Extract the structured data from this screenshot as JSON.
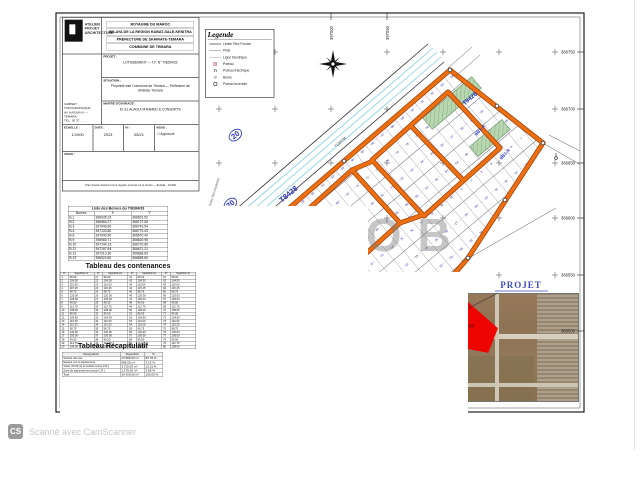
{
  "scanner": {
    "badge": "CS",
    "text": "Scanné avec CamScanner"
  },
  "title_block": {
    "firm_lines": [
      "ATELIER",
      "PROJET",
      "ARCHITECTURE"
    ],
    "org_lines": [
      "ROYAUME DU MAROC",
      "WILAYA DE LA REGION RABAT-SALE-KENITRA",
      "PREFECTURE DE SKHIRATE-TEMARA",
      "COMMUNE DE TEMARA"
    ],
    "cabinet_lines": [
      "CABINET TOPOGRAPHIQUE",
      "AV. HASSAN II — TEMARA",
      "TEL : 05 37 .. .. .."
    ],
    "projet_label": "PROJET :",
    "projet_text": "LOTISSEMENT — T.F. N° T/8264/33",
    "situation_label": "SITUATION :",
    "situation_text": "Propriété sise Commune de Témara — Préfecture de Skhirate-Témara",
    "moa_label": "MAITRE D'OUVRAGE :",
    "moa_text": "M. EL ALAOUI M'HAMED & CONSORTS",
    "echelle_label": "ECHELLE :",
    "echelle": "1/1000",
    "date_label": "DATE :",
    "date": "2021",
    "num_label": "N° :",
    "num": "05/21",
    "visas_label": "VISAS :",
    "visa_check": "☐ Approuvé",
    "footnote": "Plan dressé d'après le levé régulier exécuté sur le terrain — Echelle : 1/1000"
  },
  "legend": {
    "title": "Legende",
    "items": [
      {
        "sym": "solid",
        "label": "Limite Titre Foncier"
      },
      {
        "sym": "piste",
        "label": "Piste"
      },
      {
        "sym": "elec",
        "label": "Ligne Electrique"
      },
      {
        "sym": "poteau",
        "label": "Poteau"
      },
      {
        "sym": "pylone",
        "label": "Poteau Electrique"
      },
      {
        "sym": "borne",
        "label": "Borne"
      },
      {
        "sym": "incendie",
        "label": "Poteau Incendie"
      }
    ]
  },
  "bornes_table": {
    "title": "Liste des Bornes du T/8264/33",
    "headers": [
      "Bornes",
      "X",
      "Y"
    ],
    "rows": [
      [
        "B.1",
        "396935.24",
        "366691.52"
      ],
      [
        "B.2",
        "396984.27",
        "366727.05"
      ],
      [
        "B.3",
        "397040.60",
        "366743.54"
      ],
      [
        "B.4",
        "397133.80",
        "366770.43"
      ],
      [
        "B.8",
        "397040.90",
        "366670.40"
      ],
      [
        "B.9",
        "396983.71",
        "366620.95"
      ],
      [
        "B.10",
        "397144.12",
        "366720.85"
      ],
      [
        "B.11",
        "397197.84",
        "366671.21"
      ],
      [
        "B.12",
        "397213.30",
        "366688.85"
      ],
      [
        "B.13",
        "396924.50",
        "366655.60"
      ]
    ]
  },
  "contenances": {
    "title": "Tableau des contenances",
    "col_headers": [
      "N°",
      "Superficie m²"
    ],
    "groups": 4,
    "surfaces": [
      "96.00",
      "104.50",
      "110.00",
      "115.25",
      "98.75",
      "120.00",
      "105.00",
      "99.50",
      "112.75",
      "108.00",
      "96.00",
      "104.50",
      "110.00",
      "115.25",
      "98.75",
      "120.00",
      "105.00",
      "99.50",
      "112.75",
      "108.00",
      "96.00",
      "104.50",
      "110.00",
      "115.25",
      "98.75",
      "120.00",
      "105.00",
      "99.50",
      "112.75",
      "108.00",
      "96.00",
      "104.50",
      "110.00",
      "115.25",
      "98.75",
      "120.00",
      "105.00",
      "99.50",
      "112.75",
      "108.00",
      "96.00",
      "104.50",
      "110.00",
      "115.25",
      "98.75",
      "120.00",
      "105.00",
      "99.50",
      "112.75",
      "108.00",
      "96.00",
      "104.50",
      "110.00",
      "115.25",
      "98.75",
      "120.00",
      "105.00",
      "99.50",
      "112.75",
      "108.00",
      "96.00",
      "104.50",
      "110.00",
      "115.25",
      "98.75",
      "120.00",
      "105.00",
      "99.50",
      "112.75",
      "108.00",
      "96.00",
      "104.50",
      "110.00",
      "115.25",
      "98.75",
      "120.00",
      "105.00",
      "99.50",
      "112.75",
      "108.00"
    ]
  },
  "recap": {
    "title": "Tableau Récapitulatif",
    "headers": [
      "Désignation",
      "Superficie",
      "%"
    ],
    "rows": [
      [
        "Surface des lots",
        "24 580.00 m²",
        "80.78 %"
      ],
      [
        "Espace vert et équipement",
        "958.00 m²",
        "3.15 %"
      ],
      [
        "Voirie (10.00 m) et trottoirs (sous C.R.)",
        "3 715.00 m²",
        "12.21 %"
      ],
      [
        "Zone de stationnement (sous C.R.)",
        "1 175.00 m²",
        "3.86 %"
      ],
      [
        "Total",
        "30 428.00 m²",
        "100.00 %"
      ]
    ]
  },
  "map": {
    "watermark": "ВИГОВ",
    "coords_right": [
      "366750",
      "366700",
      "366650",
      "366600",
      "366550",
      "366500"
    ],
    "coords_top": [
      "397000",
      "397050"
    ],
    "coords_bottom": [
      "396900",
      "396950",
      "397000",
      "397050"
    ],
    "projet_label": "PROJET",
    "inset_ref": "T/8264/33",
    "labels": [
      {
        "text": "T8428",
        "cls": "blue-lg",
        "x": 290,
        "y": 196,
        "rot": -40
      },
      {
        "text": "71397/M",
        "cls": "small-dark",
        "x": 341,
        "y": 143,
        "rot": -40
      },
      {
        "text": "T8428",
        "cls": "blue-md",
        "x": 471,
        "y": 100,
        "rot": -40
      },
      {
        "text": "6B1-A",
        "cls": "blue-sm",
        "x": 481,
        "y": 131,
        "rot": -48
      },
      {
        "text": "6B1-A",
        "cls": "blue-sm",
        "x": 506,
        "y": 155,
        "rot": -48
      },
      {
        "text": "T8430",
        "cls": "blue-md",
        "x": 268,
        "y": 301,
        "rot": 52
      },
      {
        "text": "T/4028/49 P2",
        "cls": "small-dark",
        "x": 317,
        "y": 371,
        "rot": 78
      },
      {
        "text": "20",
        "cls": "circ",
        "x": 237,
        "y": 137,
        "rot": -40
      },
      {
        "text": "20",
        "cls": "circ",
        "x": 232,
        "y": 206,
        "rot": -40
      },
      {
        "text": "20",
        "cls": "circ",
        "x": 257,
        "y": 281,
        "rot": -40
      },
      {
        "text": "Bd Moulay Ben Abdellah",
        "cls": "tiny-gray",
        "x": 214,
        "y": 196,
        "rot": -72
      }
    ]
  }
}
